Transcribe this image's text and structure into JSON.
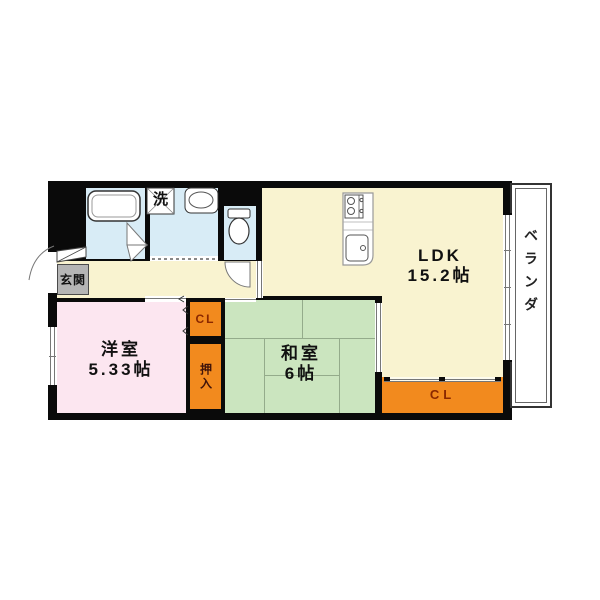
{
  "floorplan": {
    "labels": {
      "ldk_line1": "LDK",
      "ldk_line2": "15.2帖",
      "western_line1": "洋室",
      "western_line2": "5.33帖",
      "japanese_line1": "和室",
      "japanese_line2": "6帖",
      "entrance": "玄関",
      "balcony": "ベランダ",
      "laundry": "洗",
      "closet_upper": "CL",
      "closet_lower": "CL",
      "oshiire": "押入"
    },
    "colors": {
      "wall": "#0a0a0a",
      "ldk_floor": "#f9f3d0",
      "western_room_floor": "#fce6f0",
      "japanese_room_floor": "#cbe5bf",
      "wet_area_floor": "#d8ecf6",
      "closet_fill": "#f28a1e",
      "entrance_fill": "#b5b5b5",
      "closet_label_color": "#8a2800",
      "tatami_line": "#94ab8b"
    },
    "fixture_icons": {
      "bathtub": "bathtub-icon",
      "washing_machine": "washing-machine-icon",
      "wash_basin": "wash-basin-icon",
      "toilet": "toilet-icon",
      "kitchen_counter": "kitchen-counter-icon",
      "entrance_door": "entrance-door-icon",
      "bath_door": "folding-door-icon",
      "toilet_door": "swing-door-icon"
    }
  }
}
